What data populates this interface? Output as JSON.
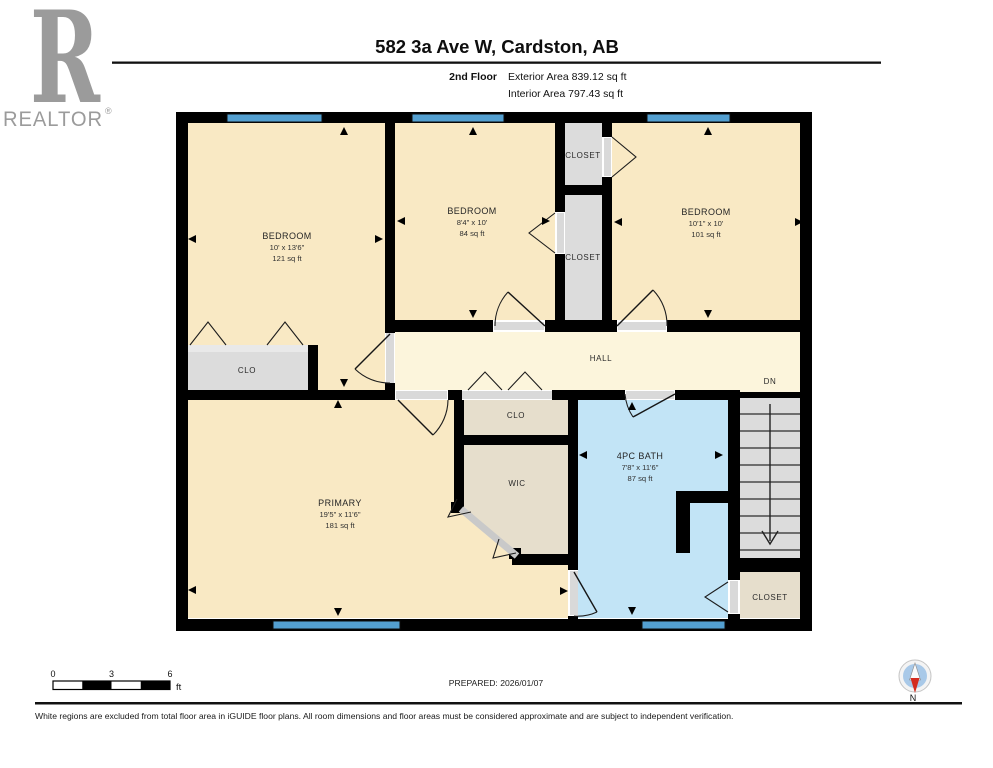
{
  "logo": {
    "letter": "R",
    "wordmark": "REALTOR",
    "registered": "®"
  },
  "header": {
    "title": "582 3a Ave W, Cardston, AB",
    "floor_label": "2nd Floor",
    "exterior_area": "Exterior Area 839.12 sq ft",
    "interior_area": "Interior Area 797.43 sq ft"
  },
  "rooms": {
    "bedroom_left": {
      "name": "BEDROOM",
      "dims": "10' x 13'6\"",
      "area": "121 sq ft"
    },
    "bedroom_middle": {
      "name": "BEDROOM",
      "dims": "8'4\" x 10'",
      "area": "84 sq ft"
    },
    "bedroom_right": {
      "name": "BEDROOM",
      "dims": "10'1\" x 10'",
      "area": "101 sq ft"
    },
    "primary": {
      "name": "PRIMARY",
      "dims": "19'5\" x 11'6\"",
      "area": "181 sq ft"
    },
    "bath": {
      "name": "4PC BATH",
      "dims": "7'8\" x 11'6\"",
      "area": "87 sq ft"
    },
    "hall": {
      "name": "HALL"
    },
    "stairs": {
      "label": "DN"
    },
    "closet_top": {
      "name": "CLOSET"
    },
    "closet_mid": {
      "name": "CLOSET"
    },
    "closet_bedroom_left": {
      "name": "CLO"
    },
    "closet_hall": {
      "name": "CLO"
    },
    "wic": {
      "name": "WIC"
    },
    "closet_bottom": {
      "name": "CLOSET"
    }
  },
  "scale_bar": {
    "tick0": "0",
    "tick1": "3",
    "tick2": "6",
    "unit": "ft"
  },
  "footer": {
    "prepared": "PREPARED: 2026/01/07",
    "compass_label": "N",
    "disclaimer": "White regions are excluded from total floor area in iGUIDE floor plans. All room dimensions and floor areas must be considered approximate and are subject to independent verification."
  },
  "colors": {
    "room_fill": "#F9E9C4",
    "hall_fill": "#FCF5DC",
    "closet_gray": "#DCDCDC",
    "closet_tan": "#E6DECC",
    "bath_fill": "#C2E4F6",
    "window_blue": "#539FD0",
    "wall": "#000000",
    "compass_disc": "#A9C9E8",
    "compass_red": "#D42B1E",
    "logo_gray": "#9B9B9B"
  }
}
